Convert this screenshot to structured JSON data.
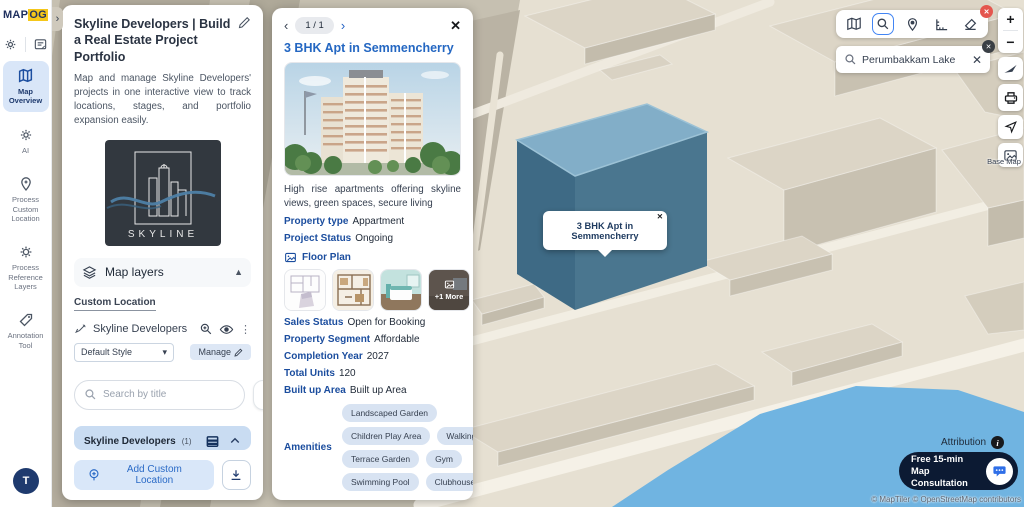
{
  "app": {
    "logo_primary": "MAP",
    "logo_secondary": "OG",
    "collapse_glyph": "›",
    "avatar_initial": "T"
  },
  "sidebar": {
    "items": [
      {
        "label": "Map Overview"
      },
      {
        "label": "AI"
      },
      {
        "label": "Process Custom Location"
      },
      {
        "label": "Process Reference Layers"
      },
      {
        "label": "Annotation Tool"
      }
    ]
  },
  "project_panel": {
    "title": "Skyline Developers | Build a Real Estate Project Portfolio",
    "description": "Map and manage Skyline Developers' projects in one interactive view to track locations, stages, and portfolio expansion easily.",
    "logo_text": "SKYLINE",
    "map_layers_label": "Map layers",
    "tab_custom_location": "Custom Location",
    "layer_name": "Skyline Developers",
    "style_select_value": "Default Style",
    "manage_label": "Manage",
    "search_placeholder": "Search by title",
    "group_title": "Skyline Developers",
    "group_count": "(1)",
    "location_item": "3 BHK Apt in Semmencherry",
    "add_location_label": "Add Custom Location"
  },
  "detail_panel": {
    "pagination": "1 / 1",
    "title": "3 BHK Apt in Semmencherry",
    "description": "High rise apartments offering skyline views, green spaces, secure living",
    "property_type_label": "Property type",
    "property_type_value": "Appartment",
    "project_status_label": "Project Status",
    "project_status_value": "Ongoing",
    "floor_plan_label": "Floor Plan",
    "more_overlay": "+1 More",
    "sales_status_label": "Sales Status",
    "sales_status_value": "Open for Booking",
    "property_segment_label": "Property Segment",
    "property_segment_value": "Affordable",
    "completion_year_label": "Completion Year",
    "completion_year_value": "2027",
    "total_units_label": "Total Units",
    "total_units_value": "120",
    "built_up_area_label": "Built up Area",
    "built_up_area_value": "Built up Area",
    "amenities_label": "Amenities",
    "amenities": [
      "Landscaped Garden",
      "Children Play Area",
      "Walking Track",
      "Terrace Garden",
      "Gym",
      "Swimming Pool",
      "Clubhouse"
    ]
  },
  "map": {
    "search_value": "Perumbakkam Lake",
    "tooltip_text": "3 BHK Apt in Semmencherry",
    "base_map_label": "Base Map",
    "attribution_label": "Attribution",
    "consultation_line1": "Free 15-min Map",
    "consultation_line2": "Consultation",
    "attribution_credits": "© MapTiler © OpenStreetMap contributors",
    "zoom_in": "+",
    "zoom_out": "−"
  },
  "colors": {
    "accent_blue": "#2563c4",
    "navy": "#0c1a33",
    "highlight_building_side": "#49768f",
    "highlight_building_top": "#82aec8",
    "water": "#70b4e1",
    "amenity_pill_bg": "#d8e3f2",
    "logo_yellow": "#f5c71a",
    "selected_item_bg": "#d9e6f8",
    "group_header_bg": "#c9dcf2"
  }
}
